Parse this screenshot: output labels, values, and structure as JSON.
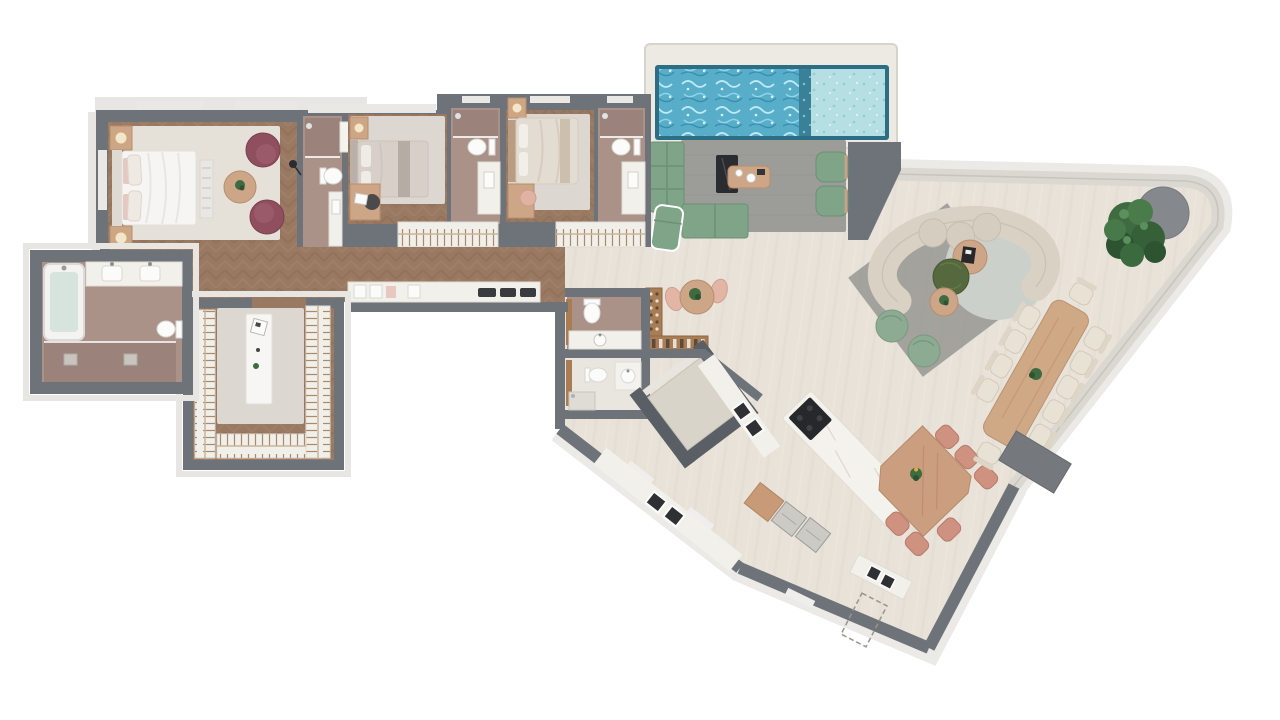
{
  "palette": {
    "wall": "#6e737a",
    "ledge": "#e7e6e2",
    "trav": "#e8e2d9",
    "wood": "#9a7962",
    "marble": "#f2f0ea",
    "bathFloor": "#ab9289",
    "showerFloor": "#9b837b",
    "deck": "#edeae3",
    "poolDeep": "#58aec9",
    "poolShallow": "#b5dfe2",
    "poolEdge": "#2e6e84",
    "sofaGreen": "#7fa487",
    "cream": "#d9d2c4",
    "oak": "#cda587",
    "terracotta": "#cf9180",
    "maroon": "#8f4f5e",
    "sage": "#8cab92",
    "olive": "#55683e",
    "rugGray": "#dcd8d1",
    "rugDark": "#9c9c98",
    "rugCream": "#e6e1d8",
    "rugRound": "#ccd0ca",
    "wardrobe": "#f1efe9",
    "hanger": "#ab8a6b",
    "treeGreen": "#3e6b40",
    "planter": "#85898d",
    "elevator": "#d9d4ca",
    "elevatorWall": "#5a5f66",
    "applGray": "#cbcac5",
    "black": "#2b2c2f"
  },
  "floorplan": {
    "type": "penthouse floor plan, top-down 3D render, no text labels",
    "rooms": [
      {
        "name": "master bedroom",
        "furniture": [
          "double bed with pink pillows",
          "two nightstands with lamps",
          "two burgundy armchairs",
          "round side table with plant",
          "floor lamp",
          "cream area rug",
          "foot bench"
        ]
      },
      {
        "name": "master bathroom",
        "furniture": [
          "bathtub",
          "double vanity with two sinks",
          "toilet",
          "walk-in shower with two drains"
        ]
      },
      {
        "name": "walk-in closet",
        "furniture": [
          "wardrobes on three sides with hanging rails",
          "white center island",
          "gray rug"
        ]
      },
      {
        "name": "bedroom 2",
        "furniture": [
          "single bed",
          "nightstand with lamp",
          "desk with chair and laptop",
          "gray rug"
        ]
      },
      {
        "name": "bathroom 2",
        "furniture": [
          "shower",
          "toilet",
          "vanity sink"
        ]
      },
      {
        "name": "bedroom 3",
        "furniture": [
          "double bed",
          "nightstand with lamp",
          "desk with peach chair",
          "gray rug"
        ]
      },
      {
        "name": "bathroom 3",
        "furniture": [
          "shower",
          "toilet",
          "vanity sink"
        ]
      },
      {
        "name": "bathroom 4",
        "furniture": [
          "shower",
          "toilet",
          "vanity sink"
        ]
      },
      {
        "name": "hallway",
        "furniture": [
          "herringbone wood floor",
          "laundry counter with sinks and appliances",
          "two built-in wardrobe strips"
        ]
      },
      {
        "name": "entry",
        "furniture": []
      },
      {
        "name": "powder room 1",
        "furniture": [
          "toilet",
          "vanity with sink"
        ]
      },
      {
        "name": "powder room 2",
        "furniture": [
          "toilet",
          "shower",
          "basin"
        ]
      },
      {
        "name": "wine bar",
        "furniture": [
          "L-shaped wine rack with bottles",
          "round bistro table with plant",
          "two peach chairs"
        ]
      },
      {
        "name": "elevator",
        "furniture": [
          "rotated cab with thick walls"
        ]
      },
      {
        "name": "kitchen",
        "furniture": [
          "angled marble island with black cooktop",
          "triangular wood dining table",
          "six terracotta chairs",
          "perimeter marble counters with four sinks",
          "cutting board",
          "two gray appliances",
          "service room with dashed outline"
        ]
      },
      {
        "name": "living lounge",
        "furniture": [
          "green L-shaped sectional",
          "green chaise lounge",
          "two green armchairs",
          "black marble console",
          "wood coffee table",
          "gray rug"
        ]
      },
      {
        "name": "terrace",
        "furniture": [
          "swimming pool deep zone",
          "pool shallow ledge",
          "white marble pool deck",
          "curved cream horseshoe sofa",
          "gray rug and round rug",
          "round wood table with black tray",
          "olive pouf",
          "small plant table",
          "two sage poufs",
          "tree in round gray planter",
          "long wood dining table with 11 cream chairs",
          "gray planter bench along railing",
          "glass railing band"
        ]
      }
    ],
    "counts": {
      "bedrooms": 3,
      "bathrooms": 6,
      "pool_zones": 2,
      "terrace_dining_seats": 11,
      "kitchen_dining_seats": 6,
      "bistro_seats": 2
    }
  }
}
